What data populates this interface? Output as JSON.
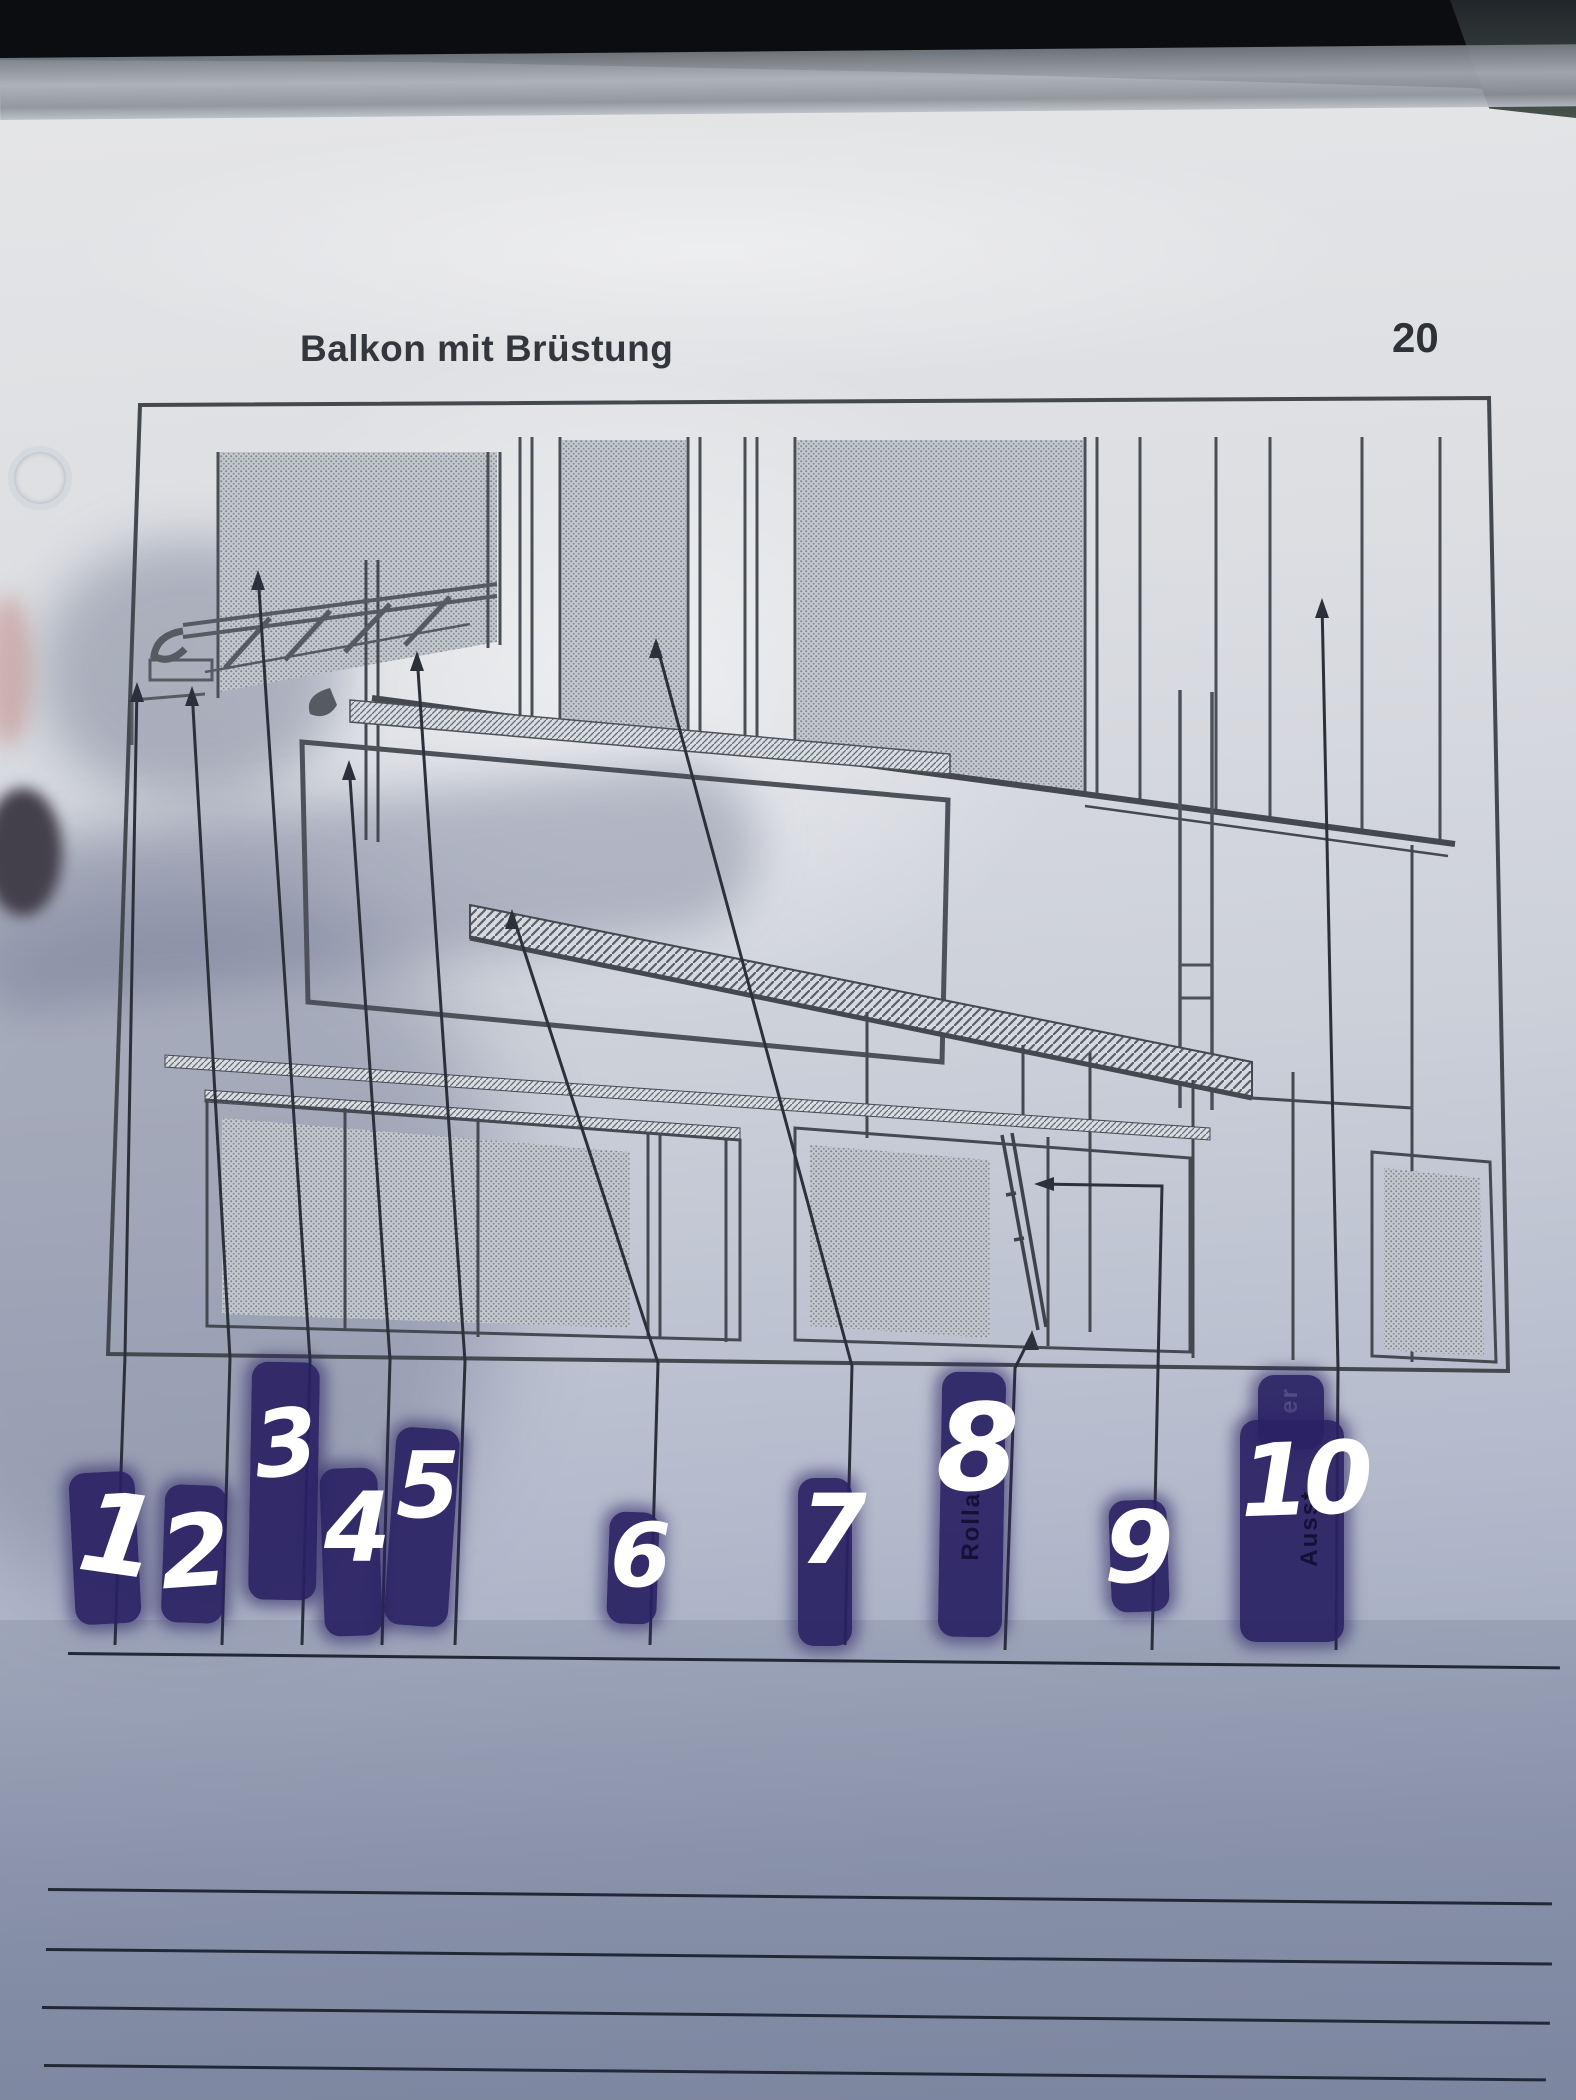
{
  "header": {
    "title": "Balkon mit Brüstung",
    "page_number": "20"
  },
  "diagram": {
    "type": "technical-line-drawing",
    "leader_arrow_count": 10
  },
  "labels": [
    {
      "value": "1",
      "fragment": ""
    },
    {
      "value": "2",
      "fragment": ""
    },
    {
      "value": "3",
      "fragment": ""
    },
    {
      "value": "4",
      "fragment": ""
    },
    {
      "value": "5",
      "fragment": ""
    },
    {
      "value": "6",
      "fragment": ""
    },
    {
      "value": "7",
      "fragment": ""
    },
    {
      "value": "8",
      "fragment": "Rolla"
    },
    {
      "value": "9",
      "fragment": ""
    },
    {
      "value": "10",
      "fragment": "Ausst",
      "fragment_top": "er"
    }
  ],
  "answer_area": {
    "underline_below_numbers": 1,
    "ruled_line_count": 4
  },
  "colors": {
    "highlight_marker": "#2a2163",
    "handwriting": "#ffffff",
    "print_ink": "#3f444c",
    "paper": "#d8dadf"
  }
}
